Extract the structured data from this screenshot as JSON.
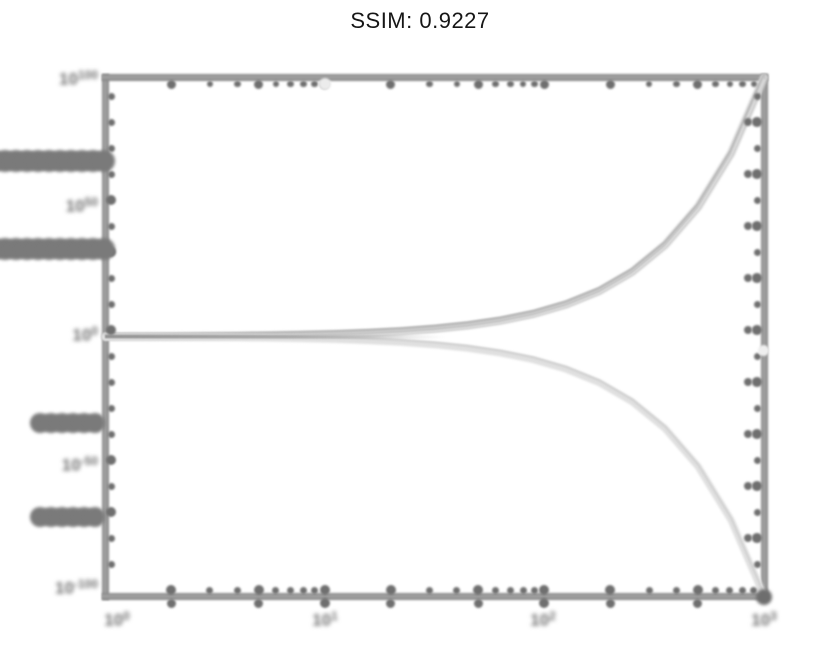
{
  "title": "SSIM: 0.9227",
  "chart_data": {
    "type": "line",
    "title": "SSIM: 0.9227",
    "x_scale": "log",
    "y_scale": "log",
    "x_range": [
      1,
      1000
    ],
    "y_range_log10": [
      -100,
      100
    ],
    "grid": false,
    "legend": false,
    "x_tick_labels": [
      {
        "base": "10",
        "exp": "0"
      },
      {
        "base": "10",
        "exp": "1"
      },
      {
        "base": "10",
        "exp": "2"
      },
      {
        "base": "10",
        "exp": "3"
      }
    ],
    "y_tick_labels": [
      {
        "base": "10",
        "exp": "100"
      },
      {
        "base": "10",
        "exp": "50"
      },
      {
        "base": "10",
        "exp": "0"
      },
      {
        "base": "10",
        "exp": "-50"
      },
      {
        "base": "10",
        "exp": "-100"
      }
    ],
    "series": [
      {
        "name": "exponential-growth",
        "color": "#c4c4c4",
        "log10_x": [
          0,
          0.15,
          0.3,
          0.45,
          0.6,
          0.75,
          0.9,
          1.05,
          1.2,
          1.35,
          1.5,
          1.65,
          1.8,
          1.95,
          2.1,
          2.25,
          2.4,
          2.55,
          2.7,
          2.85,
          3.0
        ],
        "log10_y": [
          0.1,
          0.141,
          0.2,
          0.282,
          0.398,
          0.562,
          0.794,
          1.122,
          1.585,
          2.239,
          3.162,
          4.467,
          6.31,
          8.913,
          12.589,
          17.783,
          25.119,
          35.481,
          50.119,
          70.795,
          100
        ]
      },
      {
        "name": "exponential-decay",
        "color": "#dcdcdc",
        "log10_x": [
          0,
          0.15,
          0.3,
          0.45,
          0.6,
          0.75,
          0.9,
          1.05,
          1.2,
          1.35,
          1.5,
          1.65,
          1.8,
          1.95,
          2.1,
          2.25,
          2.4,
          2.55,
          2.7,
          2.85,
          3.0
        ],
        "log10_y": [
          -0.1,
          -0.141,
          -0.2,
          -0.282,
          -0.398,
          -0.562,
          -0.794,
          -1.122,
          -1.585,
          -2.239,
          -3.162,
          -4.467,
          -6.31,
          -8.913,
          -12.589,
          -17.783,
          -25.119,
          -35.481,
          -50.119,
          -70.795,
          -100
        ]
      }
    ]
  },
  "colors": {
    "spine": "#8a8a8a",
    "tick_dot": "#6f6f6f",
    "label": "#6f6f6f",
    "growth_curve": "#c4c4c4",
    "decay_curve": "#dcdcdc",
    "title": "#161616",
    "background": "#ffffff"
  }
}
